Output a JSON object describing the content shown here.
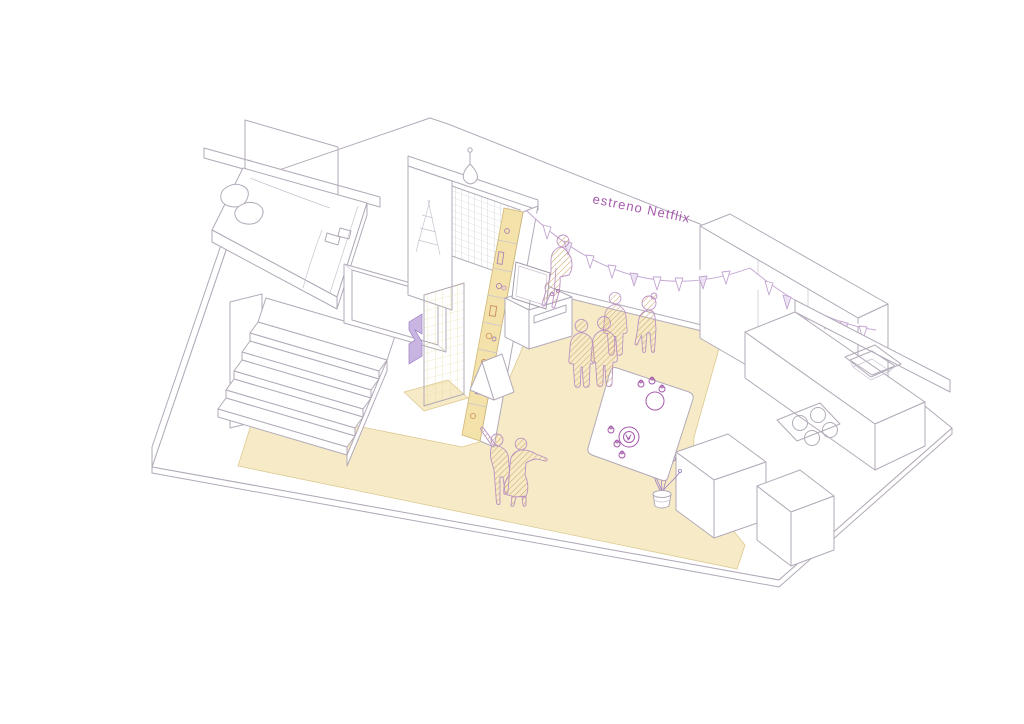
{
  "scene": {
    "banner_text": "estreno Netflix",
    "colors": {
      "accent_purple": "#a55aab",
      "garland_purple": "#c2a5d1",
      "garland_fill": "#ece3f3",
      "people_outline": "#bb92c4",
      "hatch_tan": "#cfa670",
      "purple_fixture": "#c8b5e2",
      "purple_fixture_dark": "#9b7fc0",
      "floor_yellow": "#f6ebc6",
      "tile_yellow": "#fbf3d7",
      "tile_grid": "#e7d69c",
      "shelf_yellow": "#f3e2a9",
      "line_gray": "#b2aab8"
    },
    "elements": [
      "base-slab",
      "bedroom",
      "bed",
      "pillows",
      "staircase",
      "wardrobe",
      "bathroom",
      "tiled-wall",
      "net-partition",
      "pendant-lamp",
      "media-shelf-wall",
      "tv",
      "tv-cabinet",
      "garland",
      "banner-text",
      "party-guests",
      "dancing-couple",
      "party-table",
      "tableware",
      "potted-plant",
      "kitchen-wall",
      "kitchen-counter",
      "sink",
      "cooktop",
      "kitchen-islands"
    ]
  }
}
